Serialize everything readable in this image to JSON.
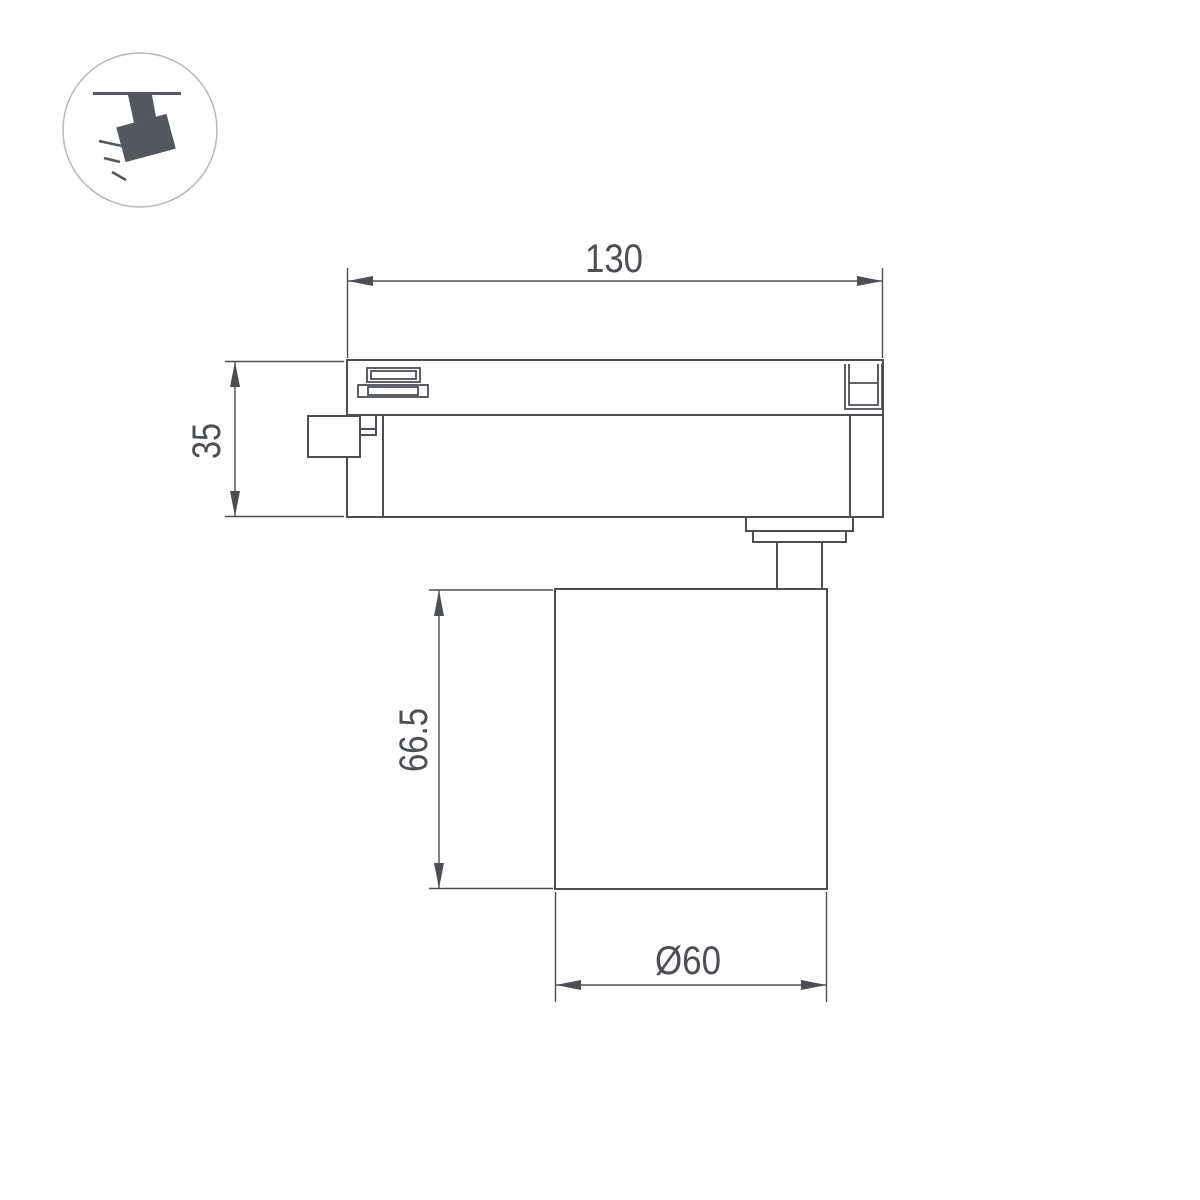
{
  "badge_icon": {
    "name": "track-spotlight-icon"
  },
  "dimensions": {
    "track_width": "130",
    "track_height": "35",
    "lamp_height": "66.5",
    "lamp_diameter": "Ø60"
  },
  "colors": {
    "line": "#4b4f54",
    "icon_glyph": "#54585e",
    "icon_circle_stroke": "#b5b8ba",
    "background": "#ffffff"
  }
}
